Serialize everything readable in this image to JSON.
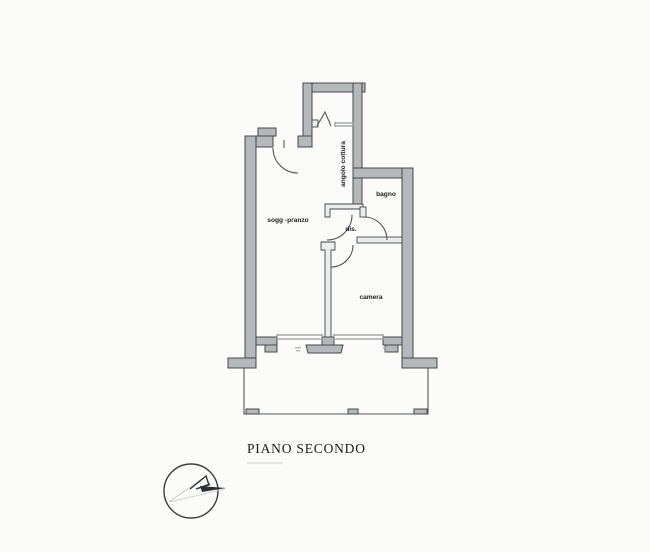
{
  "plan": {
    "title": "PIANO SECONDO",
    "rooms": {
      "living": "sogg -pranzo",
      "kitchenette": "angolo cottura",
      "bathroom": "bagno",
      "hallway": "dis.",
      "bedroom": "camera"
    },
    "colors": {
      "paper": "#fbfbf9",
      "wall_fill": "#b4b8bb",
      "wall_stroke": "#45484d",
      "thin_fill": "#eceded",
      "line": "#55585c",
      "text": "#1d1e20",
      "faint": "#c6c8c9"
    }
  }
}
